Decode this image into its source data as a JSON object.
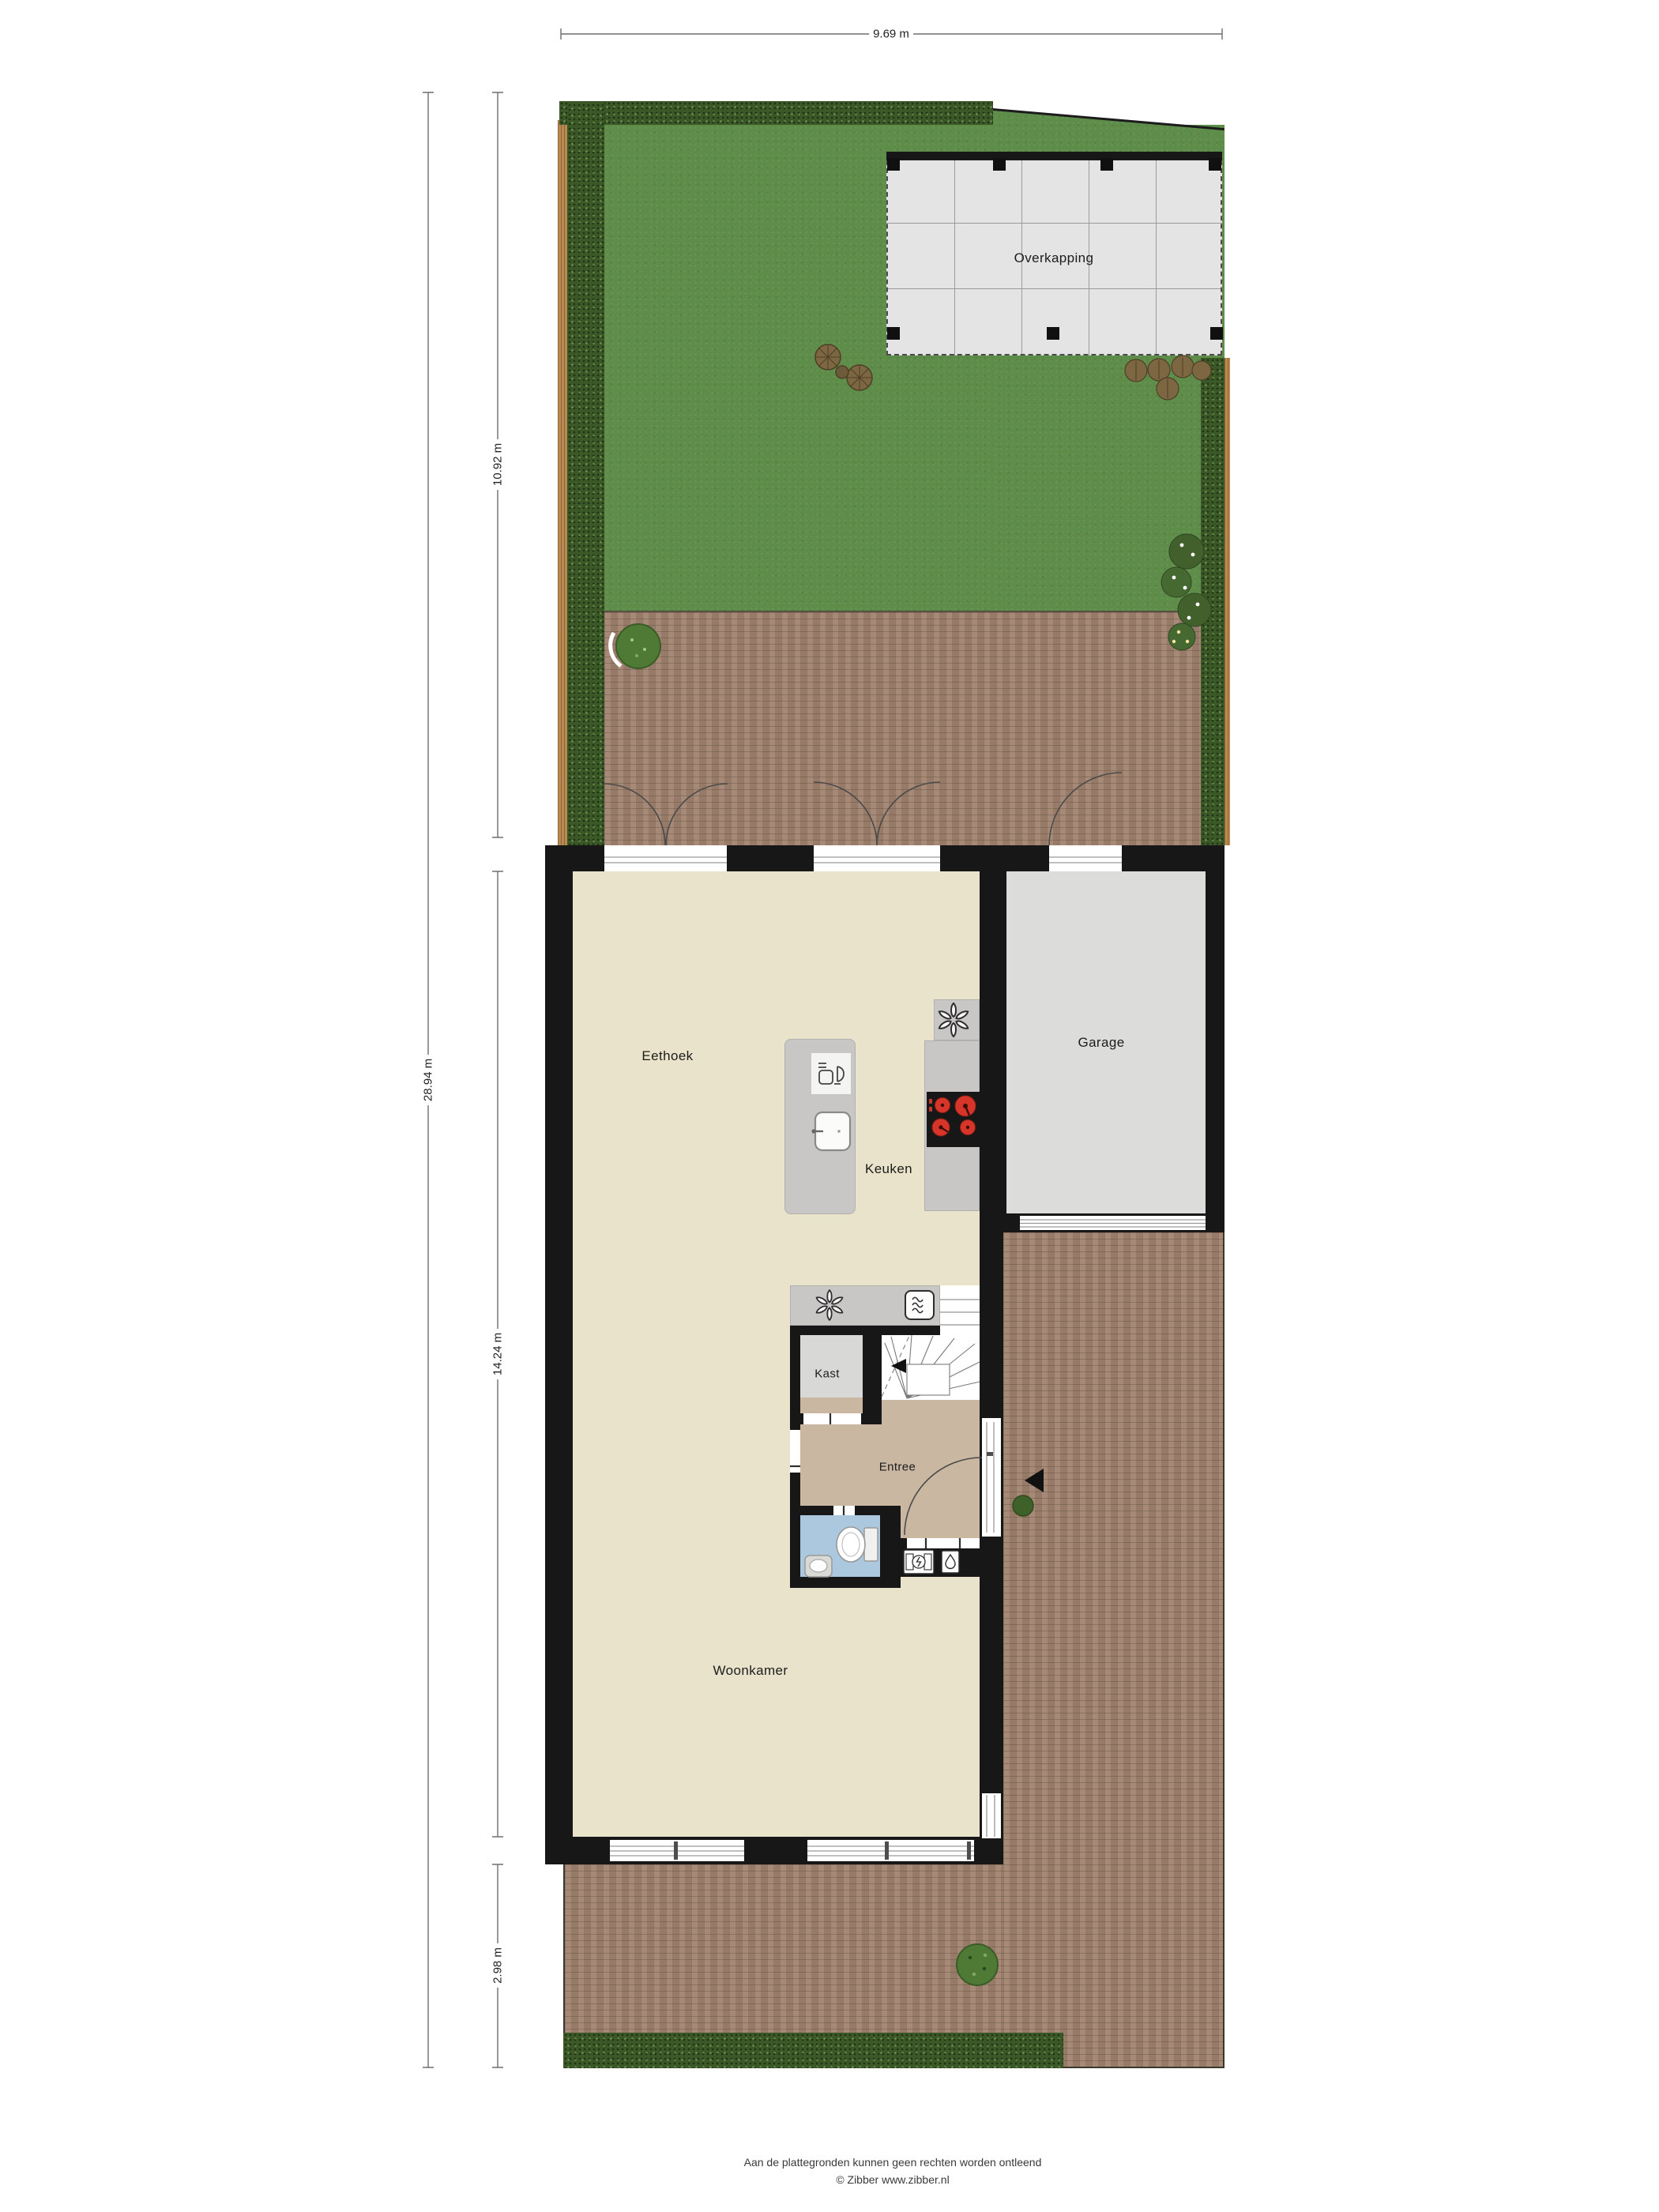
{
  "rooms": {
    "overkapping": "Overkapping",
    "eethoek": "Eethoek",
    "keuken": "Keuken",
    "garage": "Garage",
    "kast": "Kast",
    "entree": "Entree",
    "woonkamer": "Woonkamer"
  },
  "dimensions": {
    "total_width": "9.69 m",
    "total_depth": "28.94 m",
    "garden_depth": "10.92 m",
    "house_depth": "14.24 m",
    "front_yard_depth": "2.98 m"
  },
  "footer": {
    "disclaimer": "Aan de plattegronden kunnen geen rechten worden ontleend",
    "copyright": "© Zibber www.zibber.nl"
  },
  "icons": {
    "extractor_fan": "fan-icon",
    "oven": "oven-icon",
    "sink": "sink-icon",
    "dishwasher": "dishwasher-icon",
    "cooktop": "cooktop-icon",
    "toilet": "toilet-icon",
    "washbasin": "washbasin-icon",
    "electric_meter": "electric-meter-icon",
    "water_meter": "water-meter-icon",
    "entrance_arrow": "entrance-arrow-icon",
    "stairs_direction_arrow": "stairs-direction-arrow-icon"
  },
  "colors": {
    "wall": "#171717",
    "floor_main": "#eae3cb",
    "floor_entree": "#c9b7a2",
    "floor_toilet": "#abc8de",
    "floor_garage": "#dcdcdb",
    "floor_kast": "#d8d8d6",
    "counter_gray": "#c9c7c5",
    "grass_green": "#5e8c49",
    "hedge_green": "#3b5927",
    "fence_brown": "#b9894f",
    "brick_brown": "#a18470",
    "overkapping_tile": "#e4e4e4",
    "burner_red": "#d8352a"
  }
}
